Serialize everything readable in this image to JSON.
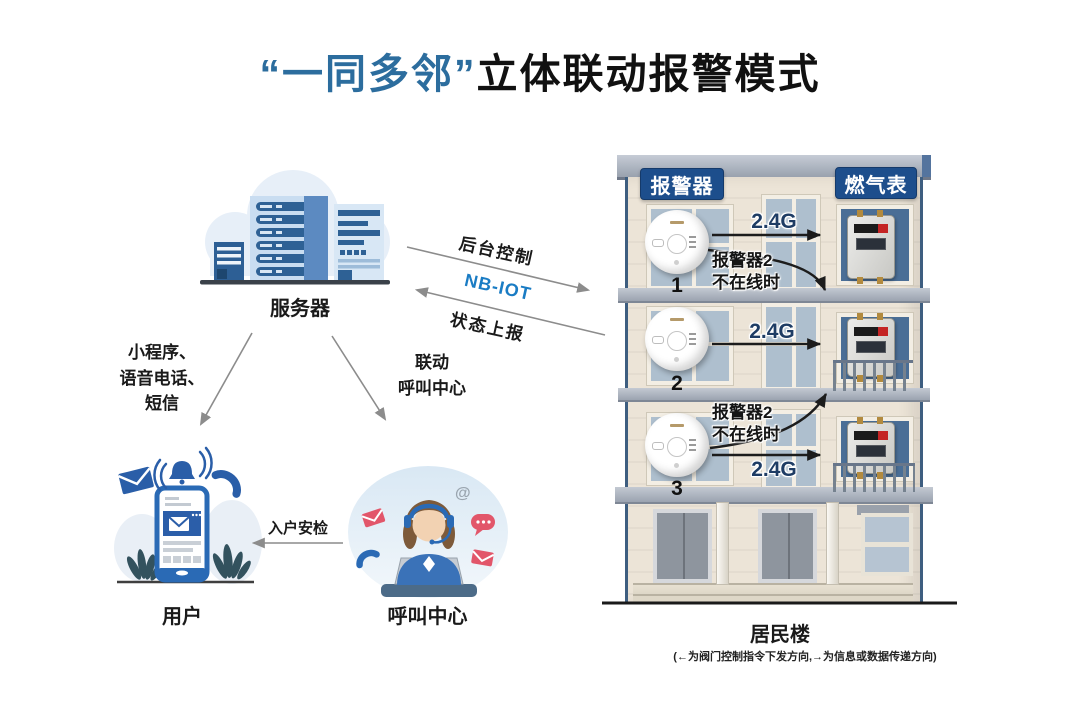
{
  "title": {
    "quoted": "“一同多邻”",
    "rest": "立体联动报警模式"
  },
  "server": {
    "label": "服务器"
  },
  "links": {
    "backend": "后台控制",
    "nbiot": "NB-IOT",
    "status": "状态上报",
    "notify": [
      "小程序、",
      "语音电话、",
      "短信"
    ],
    "linkage": [
      "联动",
      "呼叫中心"
    ],
    "inspection": "入户安检"
  },
  "user": {
    "label": "用户"
  },
  "call_center": {
    "label": "呼叫中心"
  },
  "building": {
    "badge_alarm": "报警器",
    "badge_meter": "燃气表",
    "label": "居民楼",
    "caption": "(←为阀门控制指令下发方向,→为信息或数据传递方向)",
    "floors": [
      {
        "number": "1",
        "link": "2.4G",
        "fallback": [
          "报警器2",
          "不在线时"
        ]
      },
      {
        "number": "2",
        "link": "2.4G"
      },
      {
        "number": "3",
        "link": "2.4G",
        "fallback": [
          "报警器2",
          "不在线时"
        ]
      }
    ]
  },
  "colors": {
    "accent_blue": "#2c6d9e",
    "badge_blue": "#1d4e8c",
    "nbiot_blue": "#1a7cc4",
    "g24_navy": "#1e3c64",
    "arrow_gray": "#8c8c8c",
    "arrow_black": "#1c1c1c",
    "facade": "#ece4d7",
    "red_icon": "#e2566a",
    "icon_blue": "#2a5ea8"
  }
}
